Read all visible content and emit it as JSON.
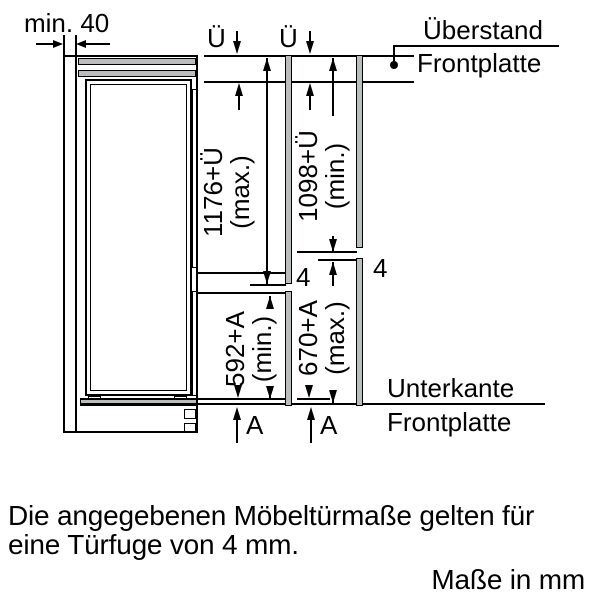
{
  "diagram": {
    "min_gap": {
      "label": "min. 40"
    },
    "top_overhang": {
      "symbol_left": "Ü",
      "symbol_right": "Ü"
    },
    "callout_top": {
      "line1": "Überstand",
      "line2": "Frontplatte"
    },
    "callout_bottom": {
      "line1": "Unterkante",
      "line2": "Frontplatte"
    },
    "dims": {
      "upper_left": {
        "value": "1176+Ü",
        "qualifier": "(max.)"
      },
      "upper_right": {
        "value": "1098+Ü",
        "qualifier": "(min.)"
      },
      "lower_left": {
        "value": "592+A",
        "qualifier": "(min.)"
      },
      "lower_right": {
        "value": "670+A",
        "qualifier": "(max.)"
      }
    },
    "gaps": {
      "left": "4",
      "right": "4"
    },
    "bottom_refs": {
      "left": "A",
      "right": "A"
    }
  },
  "notes": {
    "line1": "Die angegebenen Möbeltürmaße gelten für",
    "line2": "eine Türfuge von 4 mm.",
    "units": "Maße in mm"
  },
  "colors": {
    "line": "#000000",
    "panel_gray": "#b9bdbe",
    "background": "#ffffff"
  }
}
